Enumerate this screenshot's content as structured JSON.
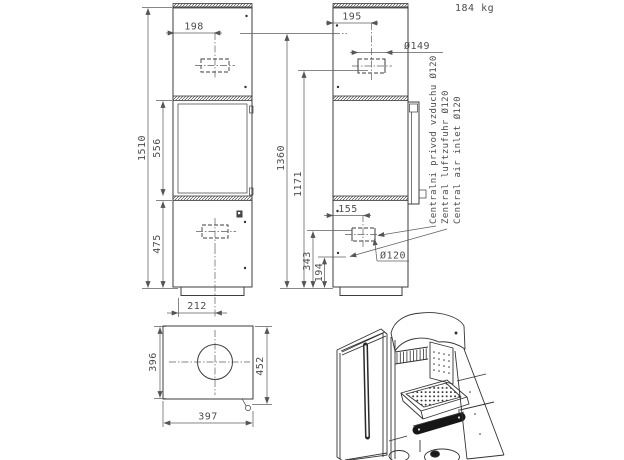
{
  "drawing": {
    "weight": "184 kg",
    "front": {
      "height": "1510",
      "door_height": "556",
      "base_height": "475",
      "top_outlet_offset": "198",
      "bottom_center_offset": "212"
    },
    "side": {
      "flue_offset": "195",
      "flue_diameter": "Ø149",
      "height_rear": "1360",
      "height_flue": "1171",
      "inlet_offset": "155",
      "inlet_diameter": "Ø120",
      "inlet_height_top": "343",
      "inlet_height_bottom": "194"
    },
    "plan": {
      "depth": "396",
      "depth_total": "452",
      "width": "397"
    },
    "notes": {
      "czech": "Centralni privod vzduchu Ø120",
      "german": "Zentral luftzufuhr Ø120",
      "english": "Central air inlet Ø120"
    }
  },
  "colors": {
    "line": "#3c3c3c",
    "dim_line": "#5f5f5f",
    "background": "#ffffff"
  }
}
